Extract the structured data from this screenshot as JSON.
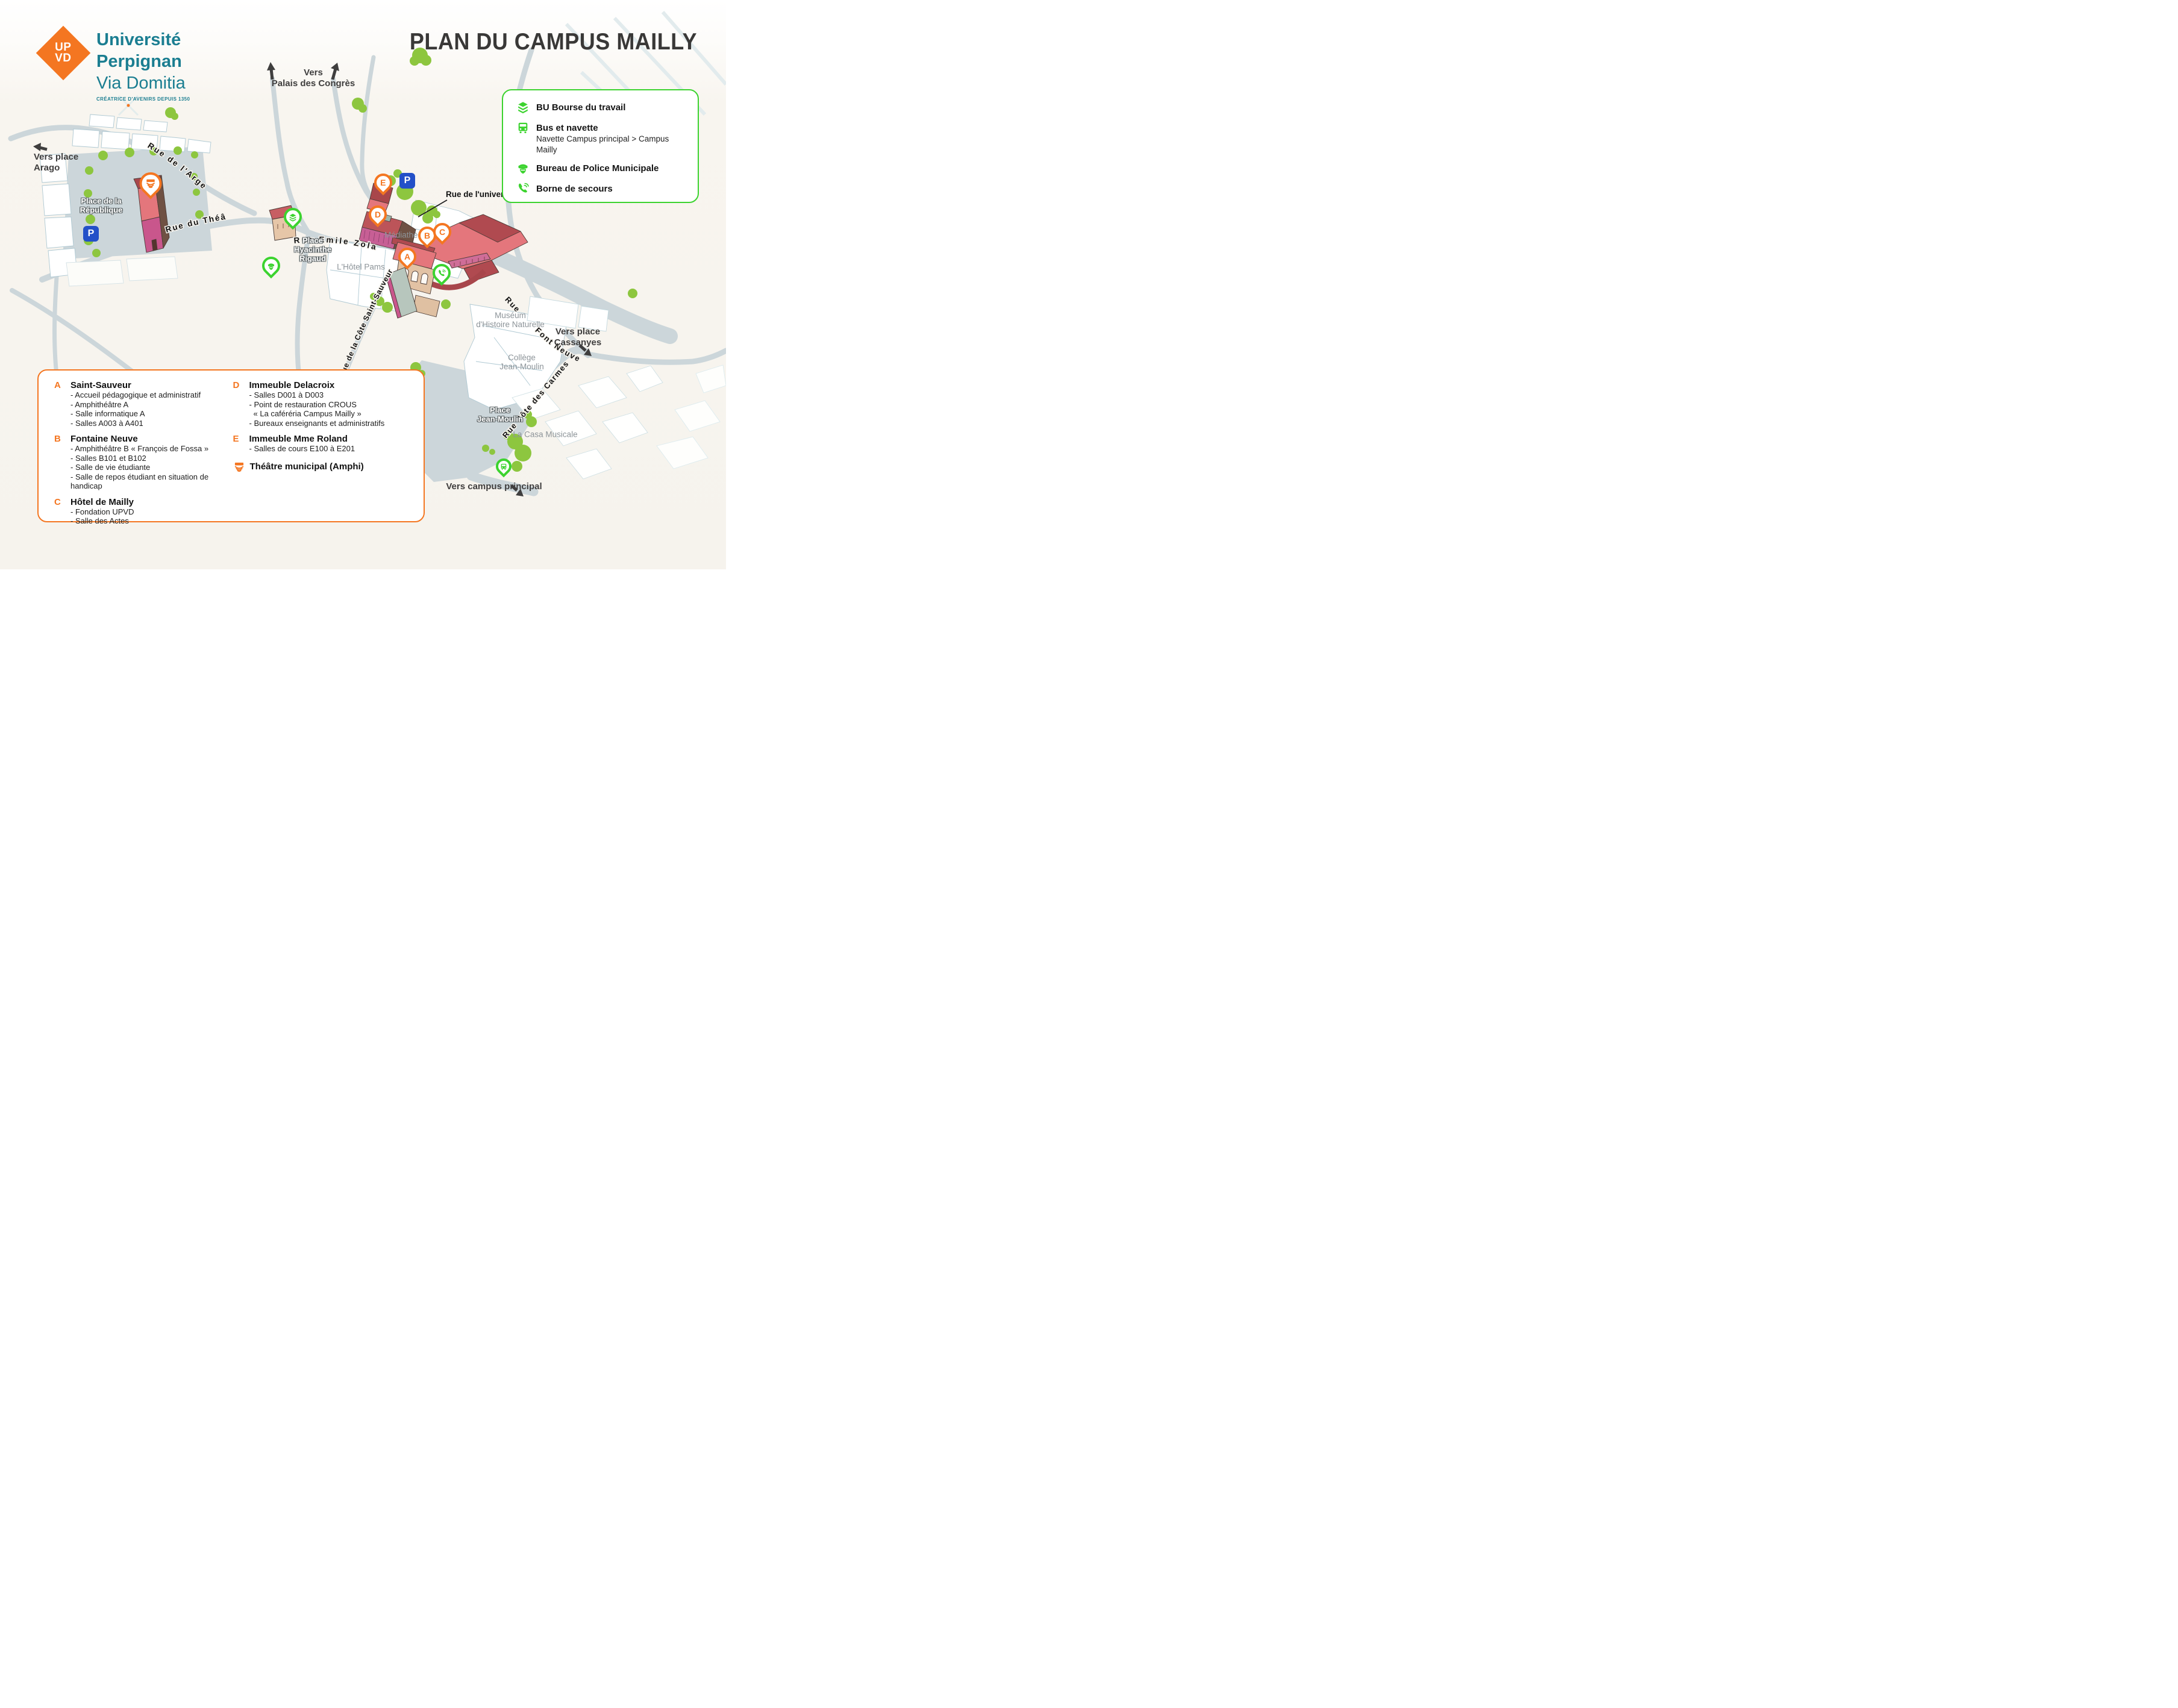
{
  "header": {
    "logo": {
      "acronym_top": "UP",
      "acronym_bottom": "VD",
      "line1": "Université",
      "line2": "Perpignan",
      "line3": "Via Domitia",
      "tagline": "CRÉATRICE D'AVENIRS DEPUIS 1350"
    },
    "title": "PLAN DU CAMPUS MAILLY"
  },
  "services_legend": {
    "items": [
      {
        "icon": "books-icon",
        "label": "BU Bourse du travail",
        "sub": ""
      },
      {
        "icon": "bus-icon",
        "label": "Bus et navette",
        "sub": "Navette Campus principal > Campus Mailly"
      },
      {
        "icon": "police-icon",
        "label": "Bureau de Police Municipale",
        "sub": ""
      },
      {
        "icon": "phone-icon",
        "label": "Borne de secours",
        "sub": ""
      }
    ]
  },
  "buildings_legend": {
    "columns": [
      [
        {
          "letter": "A",
          "title": "Saint-Sauveur",
          "items": [
            "- Accueil pédagogique et administratif",
            "- Amphithéâtre A",
            "- Salle informatique A",
            "- Salles A003 à A401"
          ]
        },
        {
          "letter": "B",
          "title": "Fontaine Neuve",
          "items": [
            "- Amphithéâtre B « François de Fossa »",
            "- Salles B101 et B102",
            "- Salle de vie étudiante",
            "- Salle de repos étudiant en situation de handicap"
          ]
        },
        {
          "letter": "C",
          "title": "Hôtel de Mailly",
          "items": [
            "- Fondation UPVD",
            "- Salle des Actes"
          ]
        }
      ],
      [
        {
          "letter": "D",
          "title": "Immeuble Delacroix",
          "items": [
            "- Salles D001 à D003",
            "- Point de restauration CROUS",
            "« La caféréria Campus Mailly »",
            "- Bureaux enseignants et administratifs"
          ]
        },
        {
          "letter": "E",
          "title": "Immeuble Mme Roland",
          "items": [
            "- Salles de cours E100 à E201"
          ]
        }
      ]
    ],
    "theatre_label": "Théâtre municipal (Amphi)"
  },
  "map": {
    "parking_label": "P",
    "pins": {
      "a": {
        "letter": "A"
      },
      "b": {
        "letter": "B"
      },
      "c": {
        "letter": "C"
      },
      "d": {
        "letter": "D"
      },
      "e": {
        "letter": "E"
      }
    },
    "streets": {
      "argenterie": "Rue de l'Argenterie",
      "theatre": "Rue du Théâtre",
      "zola": "Rue Emile Zola",
      "saint_sauveur": "Rue de la Côte Saint-Sauveur",
      "universite": "Rue de l'université",
      "rue_prefix": "Rue",
      "font_neuve": "Font Neuve",
      "carmes": "Rue Côte des Carmes"
    },
    "places": {
      "republique": [
        "Place de la",
        "République"
      ],
      "rigaud": [
        "Place",
        "Hyacinthe",
        "Rigaud"
      ],
      "mediatheque": "Médiathèque",
      "hotel_pams": "L'Hôtel Pams",
      "museum": [
        "Muséum",
        "d'Histoire Naturelle"
      ],
      "college": [
        "Collège",
        "Jean-Moulin"
      ],
      "place_jean_moulin": [
        "Place",
        "Jean-Moulin"
      ],
      "casa": "La Casa Musicale"
    },
    "directions": {
      "arago": [
        "Vers place",
        "Arago"
      ],
      "palais": [
        "Vers",
        "Palais des Congrès"
      ],
      "cassanyes": [
        "Vers place",
        "Cassanyes"
      ],
      "campus": "Vers campus principal"
    }
  },
  "colors": {
    "accent_orange": "#f47621",
    "accent_green": "#3cd32f",
    "brand_teal": "#1b7e91",
    "parking_blue": "#2350c8",
    "title_dark": "#393837"
  }
}
